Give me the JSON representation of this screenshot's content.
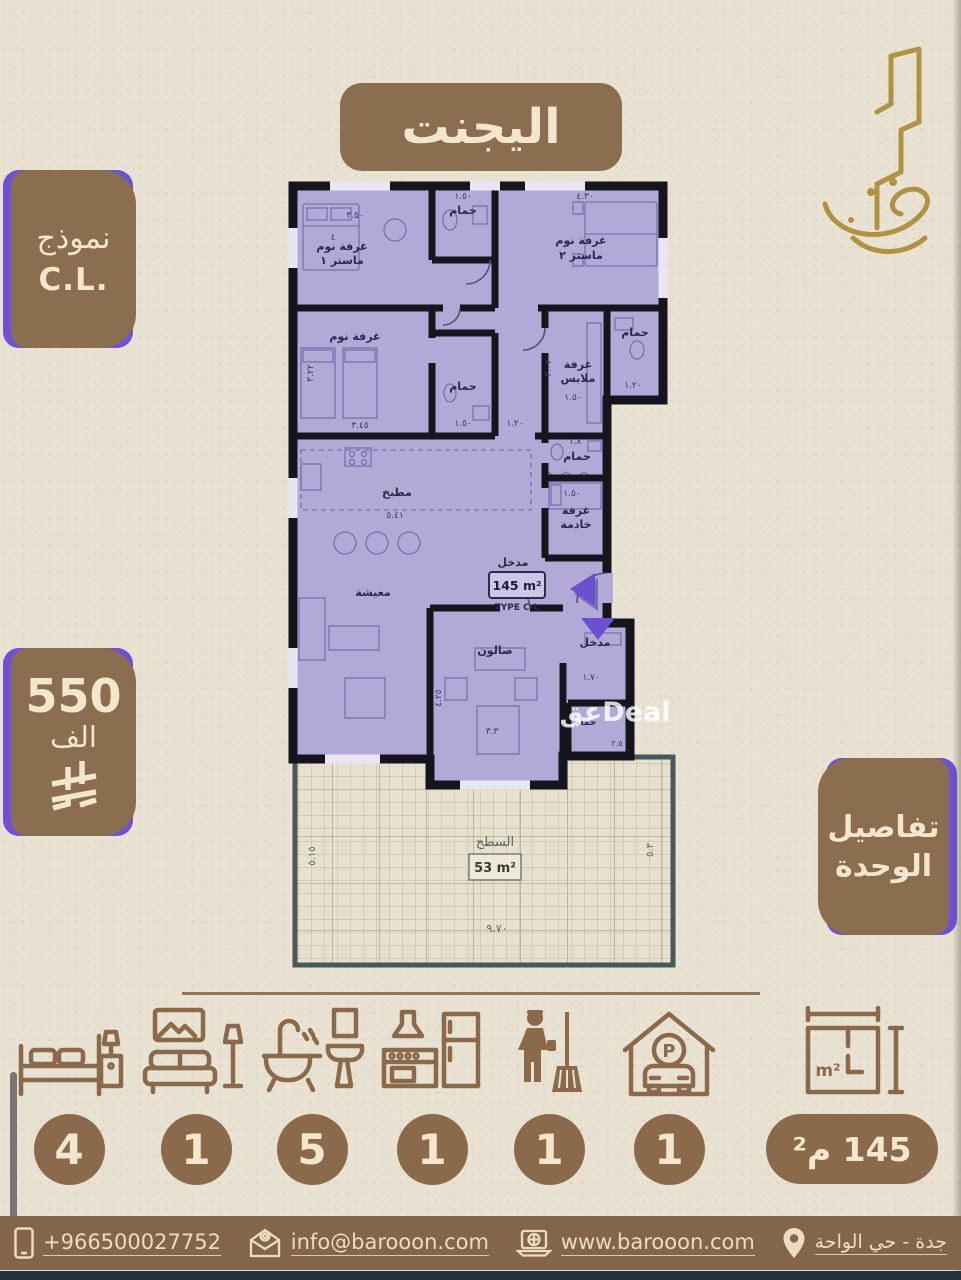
{
  "theme": {
    "bg": "#e9e2d2",
    "brown": "#8b6d50",
    "footer_brown": "#83654a",
    "cream": "#f3e6cc",
    "purple": "#6c50d8",
    "plan_fill": "#b2a9d6",
    "gold": "#b09245"
  },
  "title_badge": {
    "label": "اليجنت"
  },
  "logo": {
    "icon": "baroon-calligraphy-logo"
  },
  "model_badge": {
    "line1": "نموذج",
    "line2": "C.L."
  },
  "price_badge": {
    "amount": "550",
    "unit": "الف",
    "currency_icon": "saudi-riyal-icon"
  },
  "details_badge": {
    "line1": "تفاصيل",
    "line2": "الوحدة"
  },
  "plan": {
    "rooms": {
      "bedroom": "غرفة نوم",
      "master1": "ماستر ١",
      "master2": "ماستر ٢",
      "bath": "حمام",
      "dressing1": "غرفة",
      "dressing2": "ملابس",
      "kitchen": "مطبخ",
      "living": "معيشة",
      "maid1": "غرفة",
      "maid2": "خادمة",
      "entrance": "مدخل",
      "salon": "صالون",
      "terrace": "السطح"
    },
    "dims": {
      "d350": "٣.٥٠",
      "d150": "١.٥٠",
      "d430": "٤.٣٠",
      "d4": "٤",
      "d345": "٣.٤٥",
      "d322": "٣.٢٢",
      "d120": "١.٢٠",
      "d302": "٣.٠٢",
      "d541": "٥.٤١",
      "d18": "١.٨",
      "d170": "١.٧٠",
      "d33": "٣.٣",
      "d425": "٤.٢٥",
      "d970": "٩.٧٠",
      "d515": "٥.١٥",
      "d53": "٥.٣",
      "d25": "٢.٥"
    },
    "area_box": {
      "area": "145 m²",
      "type": "TYPE C-L"
    },
    "terrace_area": "53 m²",
    "watermark": "عقDeal"
  },
  "features": [
    {
      "name": "bedrooms",
      "icon": "bed-icon",
      "count": "4"
    },
    {
      "name": "living-rooms",
      "icon": "sofa-icon",
      "count": "1"
    },
    {
      "name": "bathrooms",
      "icon": "bathtub-icon",
      "count": "5"
    },
    {
      "name": "kitchens",
      "icon": "kitchen-icon",
      "count": "1"
    },
    {
      "name": "maid-rooms",
      "icon": "maid-icon",
      "count": "1"
    },
    {
      "name": "parking",
      "icon": "parking-icon",
      "count": "1"
    },
    {
      "name": "area",
      "icon": "area-icon",
      "count": "145 م²"
    }
  ],
  "footer": {
    "phone": "+966500027752",
    "email": "info@barooon.com",
    "website": "www.barooon.com",
    "location": "جدة - حي الواحة"
  }
}
